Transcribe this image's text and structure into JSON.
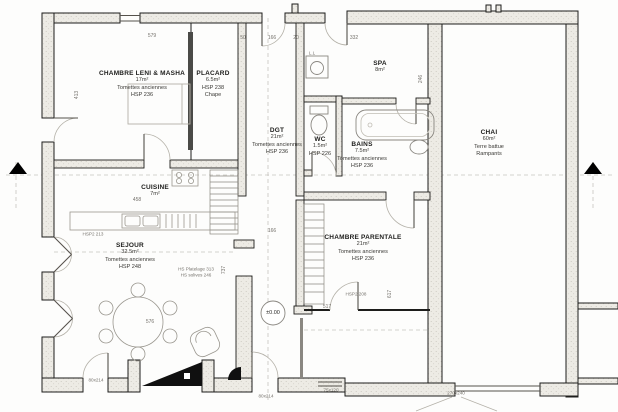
{
  "rooms": {
    "chambre_lm": {
      "name": "CHAMBRE LENI & MASHA",
      "area": "17m²",
      "floor": "Tomettes anciennes",
      "height": "HSP 236"
    },
    "placard": {
      "name": "PLACARD",
      "area": "6.5m²",
      "height": "HSP 238",
      "floor": "Chape"
    },
    "dgt": {
      "name": "DGT",
      "area": "21m²",
      "floor": "Tomettes anciennes",
      "height": "HSP 236"
    },
    "wc": {
      "name": "WC",
      "area": "1.5m²",
      "height": "HSP 226"
    },
    "spa": {
      "name": "SPA",
      "area": "8m²"
    },
    "bains": {
      "name": "BAINS",
      "area": "7.5m²",
      "floor": "Tomettes anciennes",
      "height": "HSP 236"
    },
    "chai": {
      "name": "CHAI",
      "area": "60m²",
      "floor": "Terre battue",
      "note": "Rampants"
    },
    "cuisine": {
      "name": "CUISINE",
      "area": "7m²"
    },
    "sejour": {
      "name": "SEJOUR",
      "area": "32.5m²",
      "floor": "Tomettes anciennes",
      "height": "HSP 248"
    },
    "chambre_parentale": {
      "name": "CHAMBRE PARENTALE",
      "area": "21m²",
      "floor": "Tomettes anciennes",
      "height": "HSP 236"
    }
  },
  "annotations": {
    "level": "±0.00",
    "opening": "270x240",
    "hsp2_left": "HSP2 213",
    "hsp2_right": "HSP2 208",
    "platelage": "HS Platelage 313",
    "solives": "HS solives 246",
    "washer": "L.L",
    "door_entry": "80x214",
    "door_terrace": "75x120"
  },
  "dimensions": {
    "top_579": "579",
    "top_50": "50",
    "top_166": "166",
    "top_20": "20",
    "top_332": "332",
    "left_413": "413",
    "spa_246": "246",
    "kitchen_458": "458",
    "mid_166": "166",
    "sejour_576": "576",
    "cp_517": "517",
    "cp_617": "617",
    "corr_737": "737"
  },
  "colors": {
    "wall_fill": "#eceae4",
    "line": "#1d1d1b",
    "dim_text": "#75726c",
    "stove": "#101010"
  }
}
